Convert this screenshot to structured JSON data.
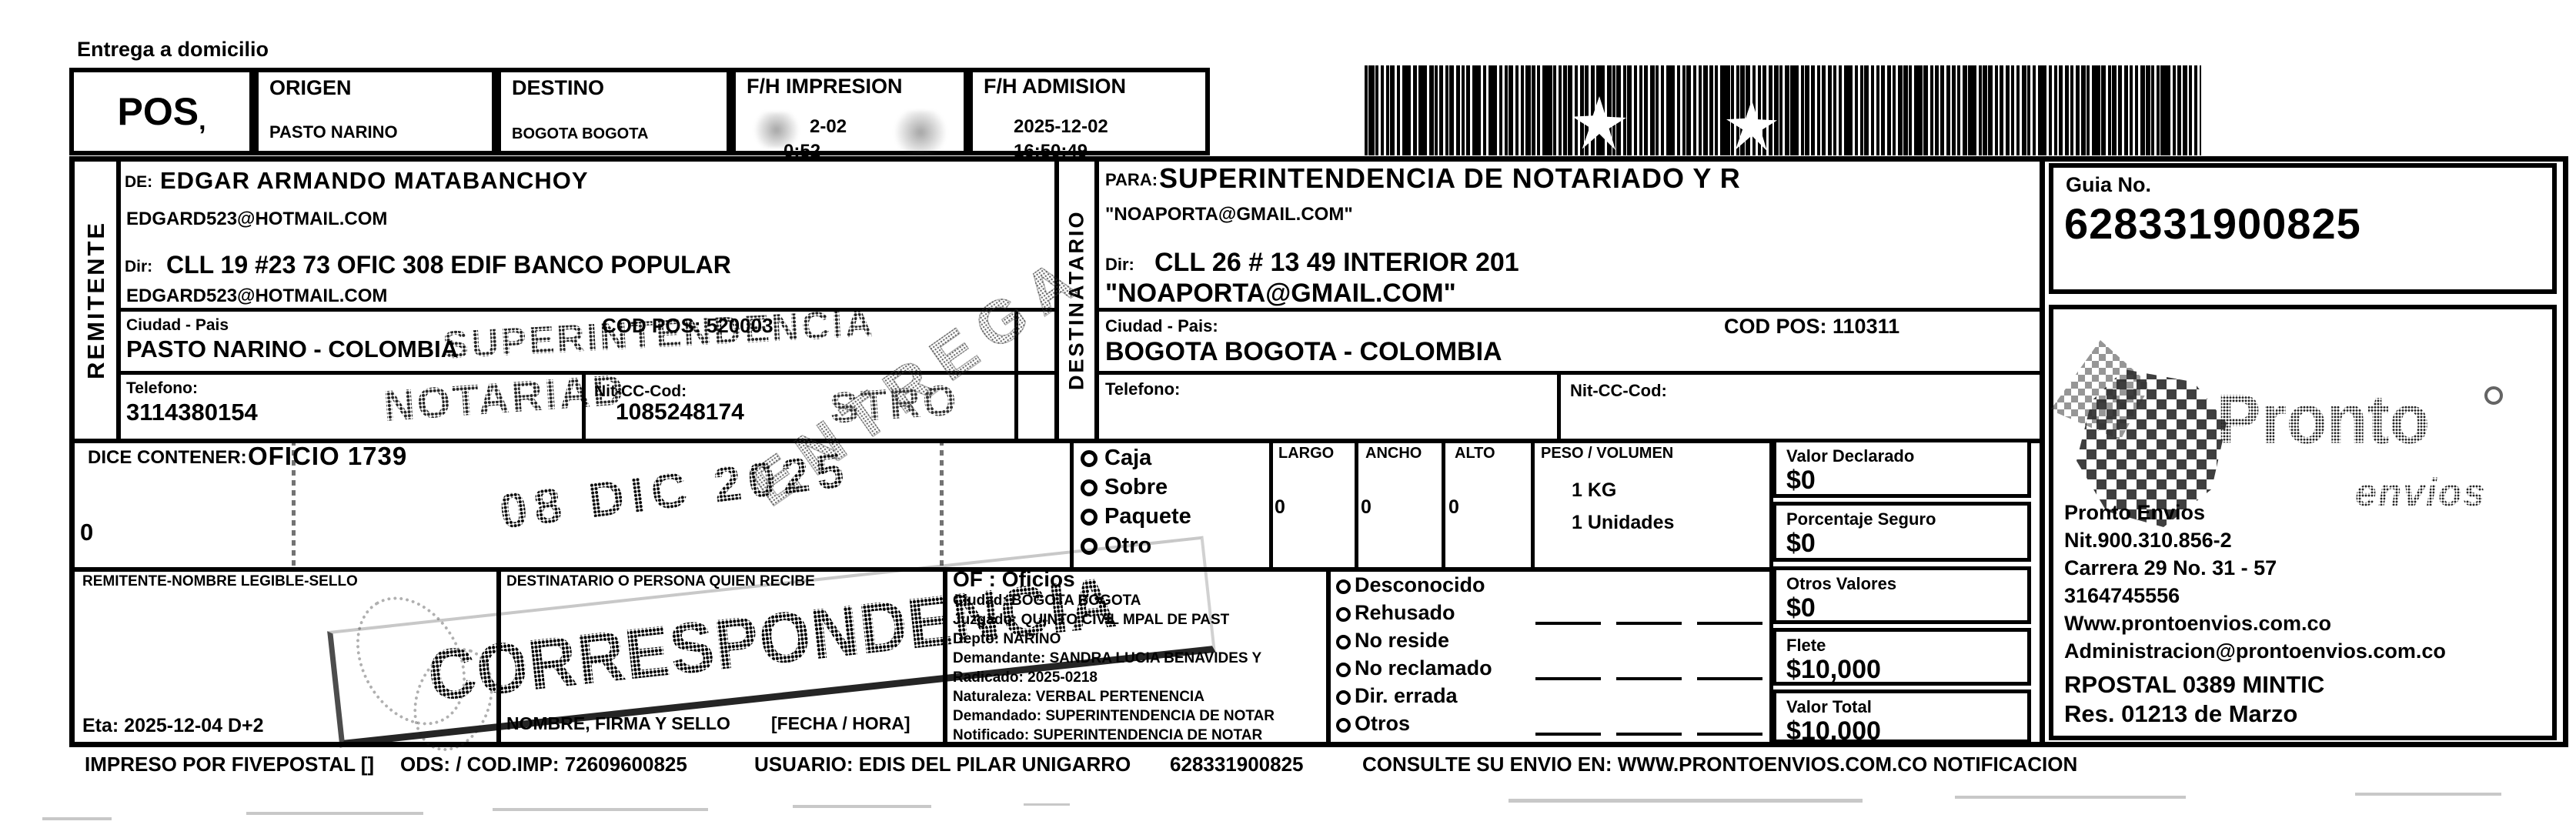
{
  "document": {
    "type_note": "Entrega a domicilio"
  },
  "header": {
    "pos": "POS",
    "pos_mark": ",",
    "origen_label": "ORIGEN",
    "origen_value": "PASTO NARINO",
    "destino_label": "DESTINO",
    "destino_value": "BOGOTA BOGOTA",
    "fh_impresion_label": "F/H IMPRESION",
    "fh_impresion_date": "2-02",
    "fh_impresion_time": "0:52",
    "fh_admision_label": "F/H ADMISION",
    "fh_admision_date": "2025-12-02",
    "fh_admision_time": "16:50:49"
  },
  "guia": {
    "label": "Guia No.",
    "number": "628331900825"
  },
  "remitente": {
    "section_label": "REMITENTE",
    "de_label": "DE:",
    "name": "EDGAR ARMANDO MATABANCHOY",
    "email": "EDGARD523@HOTMAIL.COM",
    "dir_label": "Dir:",
    "direccion": "CLL 19 #23 73 OFIC 308 EDIF BANCO POPULAR",
    "email2": "EDGARD523@HOTMAIL.COM",
    "ciudad_label": "Ciudad - Pais",
    "ciudad": "PASTO NARINO - COLOMBIA",
    "cod_pos": "COD POS: 520003",
    "telefono_label": "Telefono:",
    "telefono": "3114380154",
    "nit_label": "Nit-CC-Cod:",
    "nit": "1085248174"
  },
  "destinatario": {
    "section_label": "DESTINATARIO",
    "para_label": "PARA:",
    "name": "SUPERINTENDENCIA DE NOTARIADO Y R",
    "email": "\"NOAPORTA@GMAIL.COM\"",
    "dir_label": "Dir:",
    "direccion": "CLL 26 # 13 49 INTERIOR 201",
    "email2": "\"NOAPORTA@GMAIL.COM\"",
    "ciudad_label": "Ciudad - Pais:",
    "ciudad": "BOGOTA BOGOTA - COLOMBIA",
    "cod_pos": "COD POS: 110311",
    "telefono_label": "Telefono:",
    "nit_label": "Nit-CC-Cod:"
  },
  "contenido": {
    "dice_contener_label": "DICE CONTENER:",
    "contenido": "OFICIO 1739",
    "cantidad": "0"
  },
  "paquete": {
    "tipos": [
      "Caja",
      "Sobre",
      "Paquete",
      "Otro"
    ],
    "largo_label": "LARGO",
    "largo": "0",
    "ancho_label": "ANCHO",
    "ancho": "0",
    "alto_label": "ALTO",
    "alto": "0",
    "peso_label": "PESO / VOLUMEN",
    "peso": "1 KG",
    "unidades": "1 Unidades"
  },
  "valores": {
    "declarado_label": "Valor Declarado",
    "declarado": "$0",
    "seguro_label": "Porcentaje Seguro",
    "seguro": "$0",
    "otros_label": "Otros Valores",
    "otros": "$0",
    "flete_label": "Flete",
    "flete": "$10,000",
    "total_label": "Valor Total",
    "total": "$10,000"
  },
  "entrega": {
    "remitente_sello_label": "REMITENTE-NOMBRE LEGIBLE-SELLO",
    "eta": "Eta: 2025-12-04 D+2",
    "recibe_label": "DESTINATARIO O PERSONA QUIEN RECIBE",
    "firma_label": "NOMBRE, FIRMA Y SELLO",
    "fecha_hora_label": "[FECHA / HORA]",
    "incidencias": [
      "Desconocido",
      "Rehusado",
      "No reside",
      "No reclamado",
      "Dir. errada",
      "Otros"
    ]
  },
  "oficios": {
    "header": "OF : Oficios",
    "lines": [
      "Ciudad: BOGOTA BOGOTA",
      "Juzgado: QUINTO CIVIL MPAL DE PAST",
      "Depto: NARINO",
      "Demandante: SANDRA LUCIA BENAVIDES Y",
      "Radicado: 2025-0218",
      "Naturaleza: VERBAL PERTENENCIA",
      "Demandado: SUPERINTENDENCIA DE NOTAR",
      "Notificado: SUPERINTENDENCIA DE NOTAR"
    ]
  },
  "carrier": {
    "logo_text": "Pronto",
    "logo_sub": "envios",
    "name": "Pronto Envios",
    "nit": "Nit.900.310.856-2",
    "direccion": "Carrera 29 No. 31 - 57",
    "telefono": "3164745556",
    "web": "Www.prontoenvios.com.co",
    "email": "Administracion@prontoenvios.com.co",
    "rpostal": "RPOSTAL 0389 MINTIC",
    "resolucion": "Res. 01213 de Marzo"
  },
  "stamps": {
    "superintendencia_line1": "SUPERINTENDENCIA",
    "superintendencia_line2": "NOTARIAD",
    "superintendencia_line3": "STRO",
    "fecha": "08 DIC 2025",
    "correspondencia": "CORRESPONDENCIA",
    "diagonal": "ENTREGA"
  },
  "footer": {
    "impreso": "IMPRESO POR FIVEPOSTAL []",
    "ods": "ODS: / COD.IMP: 72609600825",
    "usuario": "USUARIO: EDIS DEL PILAR UNIGARRO",
    "guia": "628331900825",
    "consulte": "CONSULTE SU ENVIO EN: WWW.PRONTOENVIOS.COM.CO NOTIFICACION"
  },
  "colors": {
    "ink": "#000000",
    "stamp_gray": "#3a3a3a",
    "logo_gray": "#4a4a4a"
  }
}
